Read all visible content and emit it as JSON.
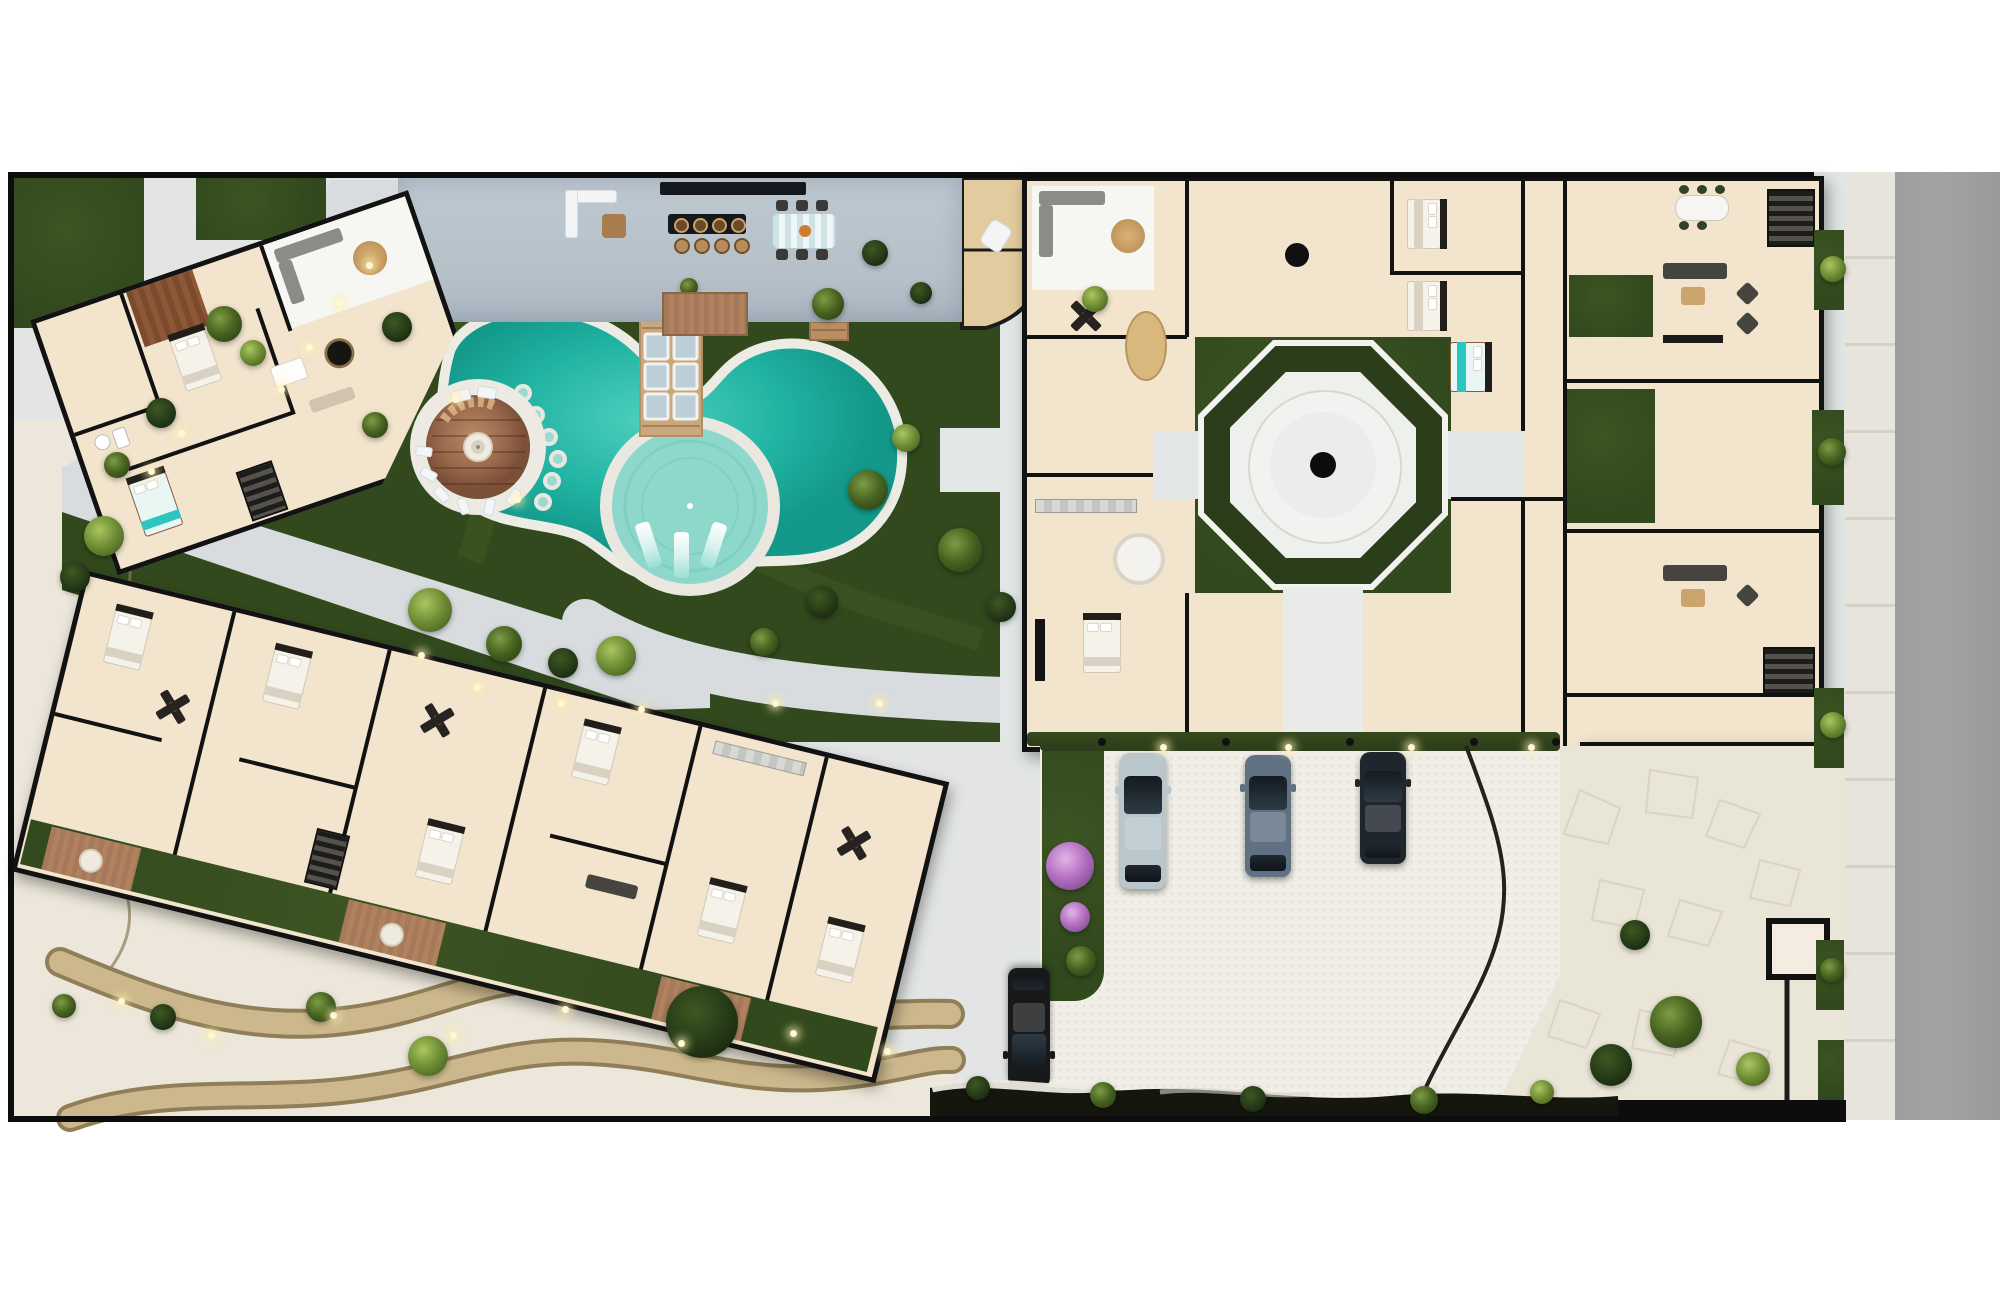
{
  "scene": {
    "title": "Residential resort complex — top-down 3D site plan rendering",
    "note": "photorealistic architectural plan; no text labels visible"
  },
  "palette": {
    "wall": "#121212",
    "beige": "#f2e4cd",
    "warm": "#ecd9ba",
    "grass": "#31491d",
    "grass2": "#53702b",
    "water": "#1fb2a1",
    "shallow": "#8ed8cb",
    "wood": "#9b6b4e",
    "concrete": "#b5c0c9",
    "path": "#d8dcde",
    "sand": "#ece7da",
    "sandpath": "#c3aa7d",
    "road": "#a3a3a3",
    "sidewalk": "#e7e4dc",
    "gravel": "#f0eee6",
    "hedge": "#2b3d1a",
    "flag": "#e9e5d7",
    "rock": "#15160d",
    "teal": "#2cc5c0",
    "purple": "#bd7fd0"
  },
  "site": {
    "boundary": {
      "label": "walled property boundary"
    },
    "road": {
      "label": "street along east edge"
    },
    "sidewalk": {
      "label": "sidewalk with paving slabs"
    },
    "terrace": {
      "label": "common amenity terrace with outdoor kitchen and bar",
      "features": [
        "white l-shaped lounge sofa",
        "bar counter",
        "bar island with 4 stools",
        "striped dining table with 6 chairs",
        "timber deck",
        "spa rooms with curved garden path"
      ]
    },
    "pool": {
      "label": "free-form resort pool",
      "stepping_stones": 6,
      "in_water_loungers": 3,
      "bridge": {
        "label": "timber bridge over pool",
        "glass_panels": 6
      },
      "sun_deck": {
        "label": "circular sunken timber lounge deck with fire pit"
      },
      "shallow_circle": {
        "label": "circular tanning shelf"
      },
      "outdoor_shower": {
        "label": "timber outdoor shower platform"
      }
    },
    "courtyard": {
      "label": "octagonal hedge courtyard with circular plaza and center drain"
    },
    "parking": {
      "label": "white-gravel parking court",
      "hedge_posts": 5,
      "cars": [
        {
          "name": "car-silver",
          "color": "#b9c6cb"
        },
        {
          "name": "car-slate",
          "color": "#5f7183"
        },
        {
          "name": "car-navy",
          "color": "#20262e"
        },
        {
          "name": "car-black",
          "color": "#17191b"
        }
      ]
    },
    "buildings": [
      {
        "id": "A",
        "label": "north-west villa (rotated plan, 2 bedrooms, teal bed)"
      },
      {
        "id": "B",
        "label": "east apartment block around octagonal courtyard with lobby"
      },
      {
        "id": "C",
        "label": "south-west apartment row with garden patios and timber decks"
      }
    ],
    "landscape": {
      "beach": {
        "label": "white sand garden with two winding lit foot-paths"
      },
      "shoreline": {
        "label": "dark rock shoreline edge"
      },
      "planting": {
        "label": "tropical trees, palms and bougainvillea"
      }
    }
  }
}
